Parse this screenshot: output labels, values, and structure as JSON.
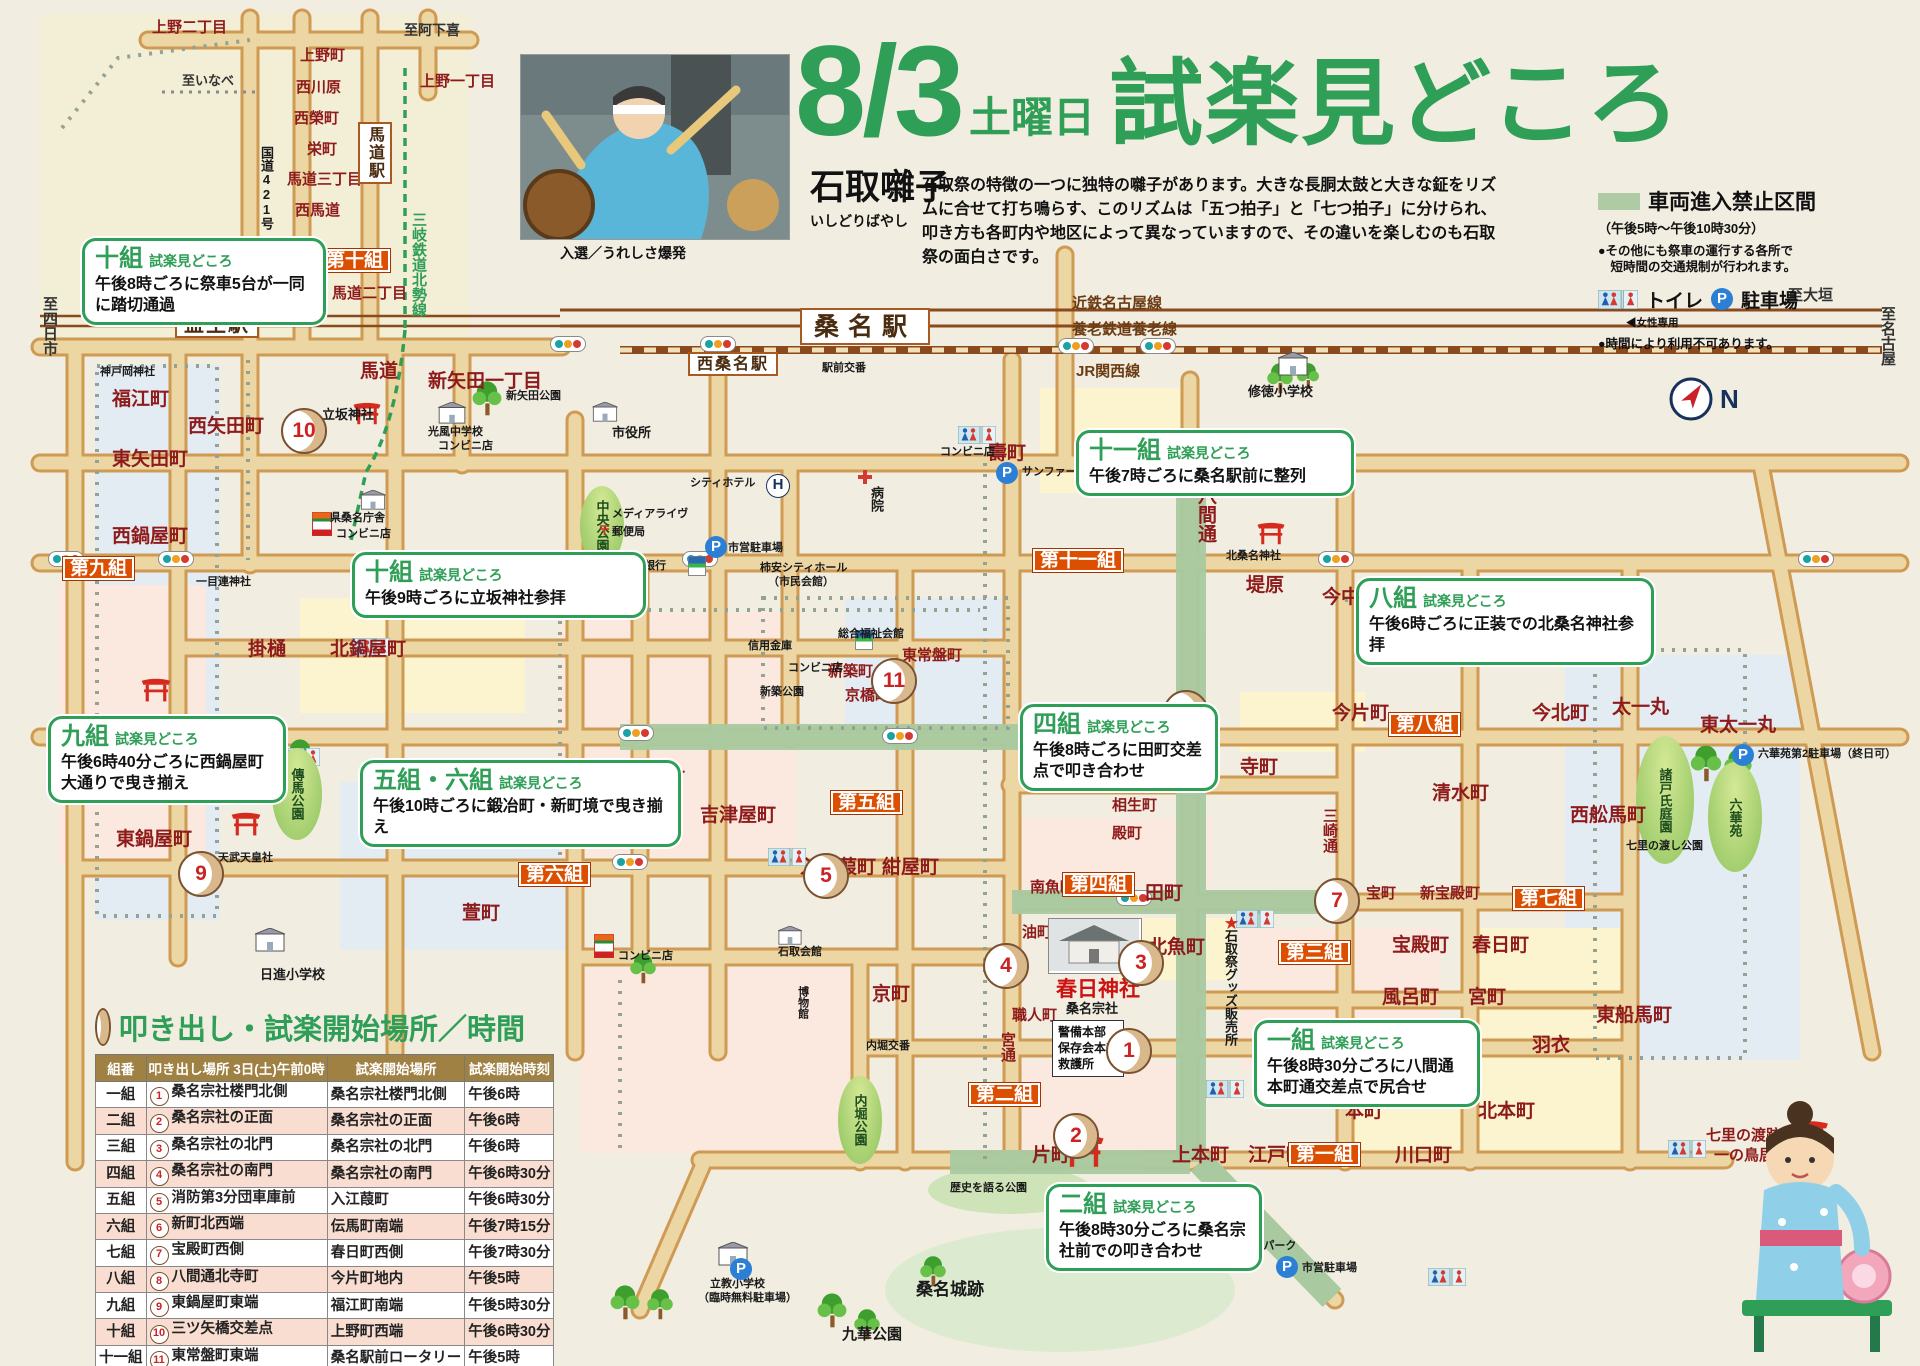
{
  "icons": {
    "p": "P",
    "n": "N",
    "h": "H",
    "post": "〒",
    "star": "★"
  },
  "header": {
    "date": "8/3",
    "day": "土曜日",
    "title": "試楽見どころ",
    "photo_caption": "入選／うれしさ爆発"
  },
  "intro": {
    "heading": "石取囃子",
    "reading": "いしどりばやし",
    "body": "石取祭の特徴の一つに独特の囃子があります。大きな長胴太鼓と大きな鉦をリズムに合せて打ち鳴らす、このリズムは「五つ拍子」と「七つ拍子」に分けられ、叩き方も各町内や地区によって異なっていますので、その違いを楽しむのも石取祭の面白さです。"
  },
  "legend": {
    "no_entry": "車両進入禁止区間",
    "no_entry_time": "（午後5時～午後10時30分）",
    "note1a": "●その他にも祭車の運行する各所で",
    "note1b": "　短時間の交通規制が行われます。",
    "toilet": "トイレ",
    "toilet_note": "◀女性専用",
    "parking": "駐車場",
    "note2": "●時間により利用不可あります。"
  },
  "callouts": {
    "tag": "試楽見どころ",
    "g10a": {
      "g": "十組",
      "b": "午後8時ごろに祭車5台が一同に踏切通過"
    },
    "g10b": {
      "g": "十組",
      "b": "午後9時ごろに立坂神社参拝"
    },
    "g9": {
      "g": "九組",
      "b": "午後6時40分ごろに西鍋屋町大通りで曳き揃え"
    },
    "g56": {
      "g": "五組・六組",
      "b": "午後10時ごろに鍛冶町・新町境で曳き揃え"
    },
    "g11": {
      "g": "十一組",
      "b": "午後7時ごろに桑名駅前に整列"
    },
    "g8": {
      "g": "八組",
      "b": "午後6時ごろに正装での北桑名神社参拝"
    },
    "g4": {
      "g": "四組",
      "b": "午後8時ごろに田町交差点で叩き合わせ"
    },
    "g1": {
      "g": "一組",
      "b": "午後8時30分ごろに八間通本町通交差点で尻合せ"
    },
    "g2": {
      "g": "二組",
      "b": "午後8時30分ごろに桑名宗社前での叩き合わせ"
    }
  },
  "map": {
    "towns": {
      "ueno2": "上野二丁目",
      "uenocho": "上野町",
      "nishikawara": "西川原",
      "nishisakae": "西榮町",
      "sakaemachi": "栄町",
      "umamichi3": "馬道三丁目",
      "nishiumamichi": "西馬道",
      "ueno1": "上野一丁目",
      "umamichi2": "馬道二丁目",
      "umamichi": "馬道",
      "shinyada1": "新矢田一丁目",
      "fukue": "福江町",
      "nishiyada": "西矢田町",
      "higashiyada": "東矢田町",
      "nishinabeya": "西鍋屋町",
      "higashinabeya": "東鍋屋町",
      "kakehi": "掛樋",
      "kitanabeya": "北鍋屋町",
      "temma": "傳馬町",
      "kayamachi": "萱町",
      "shinmachi": "新町",
      "kajimachi": "鍛冶町",
      "yoshizuya": "吉津屋町",
      "kotobuki": "壽町",
      "hachikendori": "八間通",
      "tsutsumihara": "堤原",
      "imanakamachi": "今中町",
      "shinchiku": "新築町",
      "higashitokiwa": "東常盤町",
      "kyobashi": "京橋町",
      "iriegayo": "入江葭町",
      "konya": "紺屋町",
      "minamiuo": "南魚町",
      "tamachi": "田町",
      "aburamachi": "油町",
      "kitauo": "北魚町",
      "shokunin": "職人町",
      "miyadori": "宮通",
      "teramachidori": "寺町通",
      "aioi": "相生町",
      "tonomachi": "殿町",
      "teramachi": "寺町",
      "imakatamachi": "今片町",
      "imakitamachi": "今北町",
      "shimizu": "清水町",
      "misakidori": "三崎通",
      "takaramachi": "宝町",
      "shintakaradono": "新宝殿町",
      "takaradono": "宝殿町",
      "kasugacho": "春日町",
      "furomachi": "風呂町",
      "miyamachi": "宮町",
      "miyakita": "宮北",
      "hagoromo": "羽衣",
      "honmachi": "本町",
      "kitahonmachi": "北本町",
      "kyomachi": "京町",
      "katamachi": "片町",
      "kamihonmachi": "上本町",
      "edomachi": "江戸町",
      "kawaguchi": "川口町",
      "taichimaru": "太一丸",
      "higashitaichimaru": "東太一丸",
      "nishifunaba": "西舩馬町",
      "higashifunaba": "東船馬町"
    },
    "places": {
      "kambeoka": "神戸岡神社",
      "ichimokuren": "一目連神社",
      "tachisaka": "立坂神社",
      "shinyadakoen": "新矢田公園",
      "kofuchu": "光風中学校",
      "conbini": "コンビニ店",
      "shiyakusho": "市役所",
      "chuokoen": "中央公園",
      "kenchosha": "県桑名庁舎",
      "cityhotel": "シティホテル",
      "medialive": "メディアライヴ",
      "yubinkyoku": "郵便局",
      "shiei": "市営駐車場",
      "hyakugo": "百五銀行",
      "hall1": "柿安シティホール",
      "hall2": "（市民会館）",
      "byoin": "病院",
      "koban": "駅前交番",
      "sanfare": "サンファーレ駐車場",
      "shutoku": "修徳小学校",
      "kokudo1": "国道1号",
      "kokudo421": "国道421号",
      "kitakuwana": "北桑名神社",
      "shinkin": "信用金庫",
      "fukushi": "総合福祉会館",
      "shinchikukoen": "新築公園",
      "awasuzaki": "泡洲崎八幡社",
      "tenmu": "天武天皇社",
      "temmakoen": "傳馬公園",
      "nisshin": "日進小学校",
      "ishidori": "石取会館",
      "hakubutsukan": "博物館",
      "uchiborikoban": "内堀交番",
      "uchiborikoen": "内堀公園",
      "kasuga": "春日神社",
      "soja": "桑名宗社",
      "honbu1": "警備本部",
      "honbu2": "保存会本部",
      "honbu3": "救護所",
      "goods": "石取祭グッズ販売所",
      "moroto": "諸戸氏庭園",
      "rokkaen": "六華苑",
      "shichirikoen": "七里の渡し公園",
      "rokkaenp": "六華苑第2駐車場（終日可）",
      "shichiri1": "七里の渡跡",
      "shichiri2": "一の鳥居",
      "rekishi": "歴史を語る公園",
      "joseki": "桑名城跡",
      "kyuka": "九華公園",
      "rikkyo": "立教小学校",
      "rikkyo2": "（臨時無料駐車場）",
      "kakiyasu": "柿安コミュニティパーク"
    },
    "stations": {
      "kuwana": "桑名駅",
      "nishikuwana": "西桑名駅",
      "masuo": "益生駅",
      "umamichieki": "馬道駅"
    },
    "rails": {
      "kintetsu": "近鉄名古屋線",
      "yoro": "養老鉄道養老線",
      "jr": "JR関西線",
      "sangi": "三岐鉄道北勢線"
    },
    "dirs": {
      "ogaki": "至大垣",
      "nagoya": "至名古屋",
      "yokkaichi": "至四日市",
      "inabe": "至いなべ",
      "ageki": "至阿下喜"
    },
    "groups": {
      "d1": "第一組",
      "d2": "第二組",
      "d3": "第三組",
      "d4": "第四組",
      "d5": "第五組",
      "d6": "第六組",
      "d7": "第七組",
      "d8": "第八組",
      "d9": "第九組",
      "d10": "第十組",
      "d11": "第十一組"
    },
    "drums": {
      "n1": "1",
      "n2": "2",
      "n3": "3",
      "n4": "4",
      "n5": "5",
      "n6": "6",
      "n7": "7",
      "n8": "8",
      "n9": "9",
      "n10": "10",
      "n11": "11"
    }
  },
  "table": {
    "title": "叩き出し・試楽開始場所／時間",
    "headers": [
      "組番",
      "叩き出し場所 3日(土)午前0時",
      "試楽開始場所",
      "試楽開始時刻"
    ],
    "rows": [
      {
        "g": "一組",
        "n": "1",
        "s": "桑名宗社楼門北側",
        "p": "桑名宗社楼門北側",
        "t": "午後6時"
      },
      {
        "g": "二組",
        "n": "2",
        "s": "桑名宗社の正面",
        "p": "桑名宗社の正面",
        "t": "午後6時"
      },
      {
        "g": "三組",
        "n": "3",
        "s": "桑名宗社の北門",
        "p": "桑名宗社の北門",
        "t": "午後6時"
      },
      {
        "g": "四組",
        "n": "4",
        "s": "桑名宗社の南門",
        "p": "桑名宗社の南門",
        "t": "午後6時30分"
      },
      {
        "g": "五組",
        "n": "5",
        "s": "消防第3分団車庫前",
        "p": "入江葭町",
        "t": "午後6時30分"
      },
      {
        "g": "六組",
        "n": "6",
        "s": "新町北西端",
        "p": "伝馬町南端",
        "t": "午後7時15分"
      },
      {
        "g": "七組",
        "n": "7",
        "s": "宝殿町西側",
        "p": "春日町西側",
        "t": "午後7時30分"
      },
      {
        "g": "八組",
        "n": "8",
        "s": "八間通北寺町",
        "p": "今片町地内",
        "t": "午後5時"
      },
      {
        "g": "九組",
        "n": "9",
        "s": "東鍋屋町東端",
        "p": "福江町南端",
        "t": "午後5時30分"
      },
      {
        "g": "十組",
        "n": "10",
        "s": "三ツ矢橋交差点",
        "p": "上野町西端",
        "t": "午後6時30分"
      },
      {
        "g": "十一組",
        "n": "11",
        "s": "東常盤町東端",
        "p": "桑名駅前ロータリー",
        "t": "午後5時"
      }
    ],
    "footnote": "叩き出し・試楽は各組（地区）ごとに行うため場所と時間を確認して見て回ると楽しめます。"
  }
}
